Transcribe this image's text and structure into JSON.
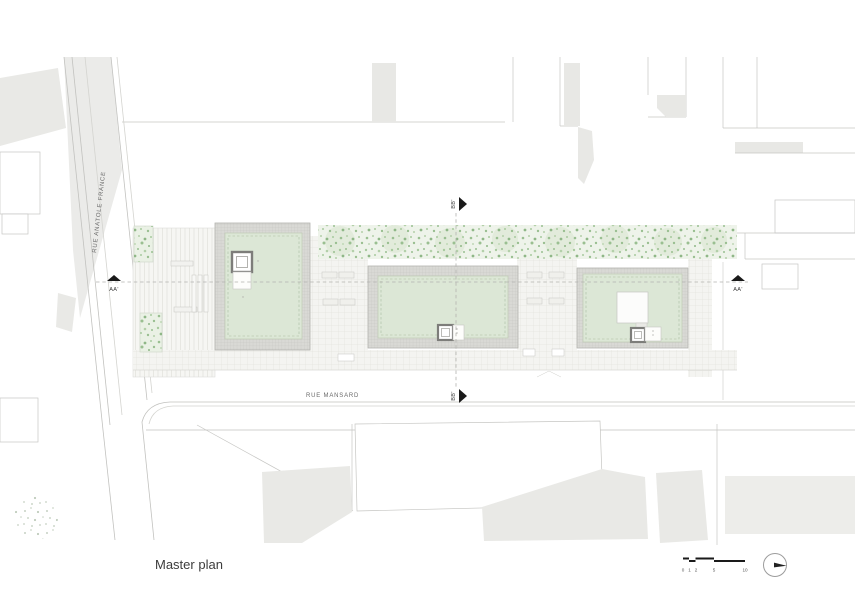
{
  "plan": {
    "title": "Master plan",
    "streets": {
      "left": "RUE ANATOLE FRANCE",
      "bottom": "RUE MANSARD"
    },
    "sections": {
      "aa_left": "AA'",
      "aa_right": "AA'",
      "bb_top": "BB'",
      "bb_bottom": "BB'"
    },
    "scale_bar": {
      "labels": [
        "0",
        "1",
        "2",
        "5",
        "10"
      ]
    },
    "icons": {
      "north": "north-arrow-icon"
    },
    "colors": {
      "paper": "#ffffff",
      "context_fill": "#e8e8e5",
      "street_fill": "#ebebe9",
      "context_line": "#c6c6c3",
      "green_roof": "#dce7d6",
      "tree_dot_green": "#9abf91",
      "paving": "#f4f4f1",
      "marker_black": "#1a1a1a",
      "label_grey": "#6a6a6a",
      "title_grey": "#3c3c3c"
    }
  }
}
